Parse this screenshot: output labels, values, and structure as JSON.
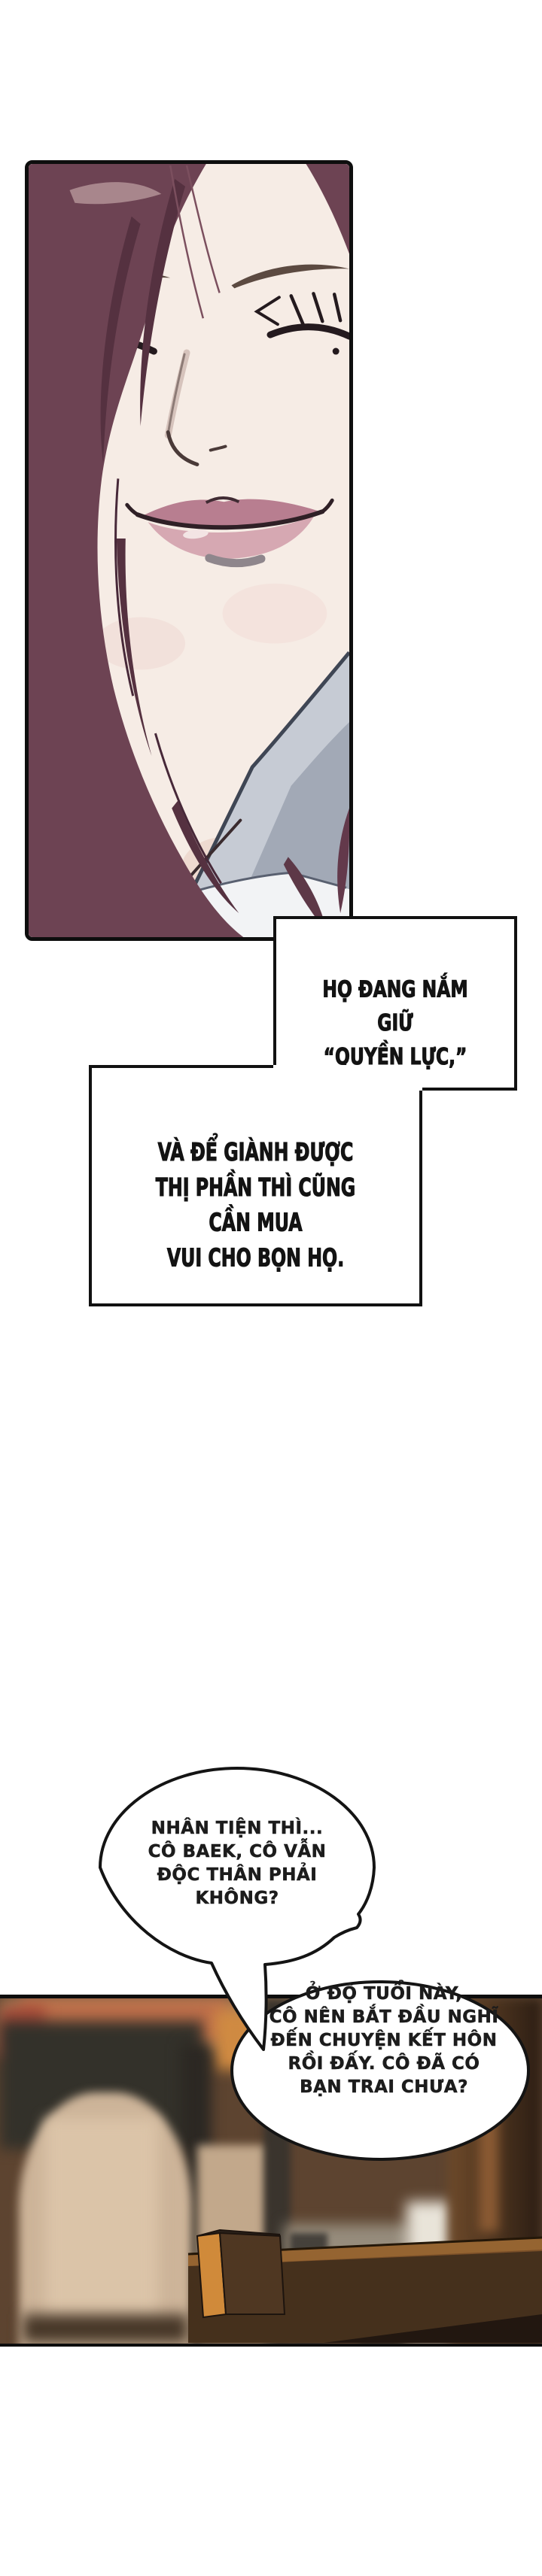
{
  "page": {
    "background": "#ffffff",
    "ink": "#111111"
  },
  "portrait_panel": {
    "subject": "close-up-of-smiling-woman-eyes-closed",
    "colors": {
      "hair": "#6d4353",
      "hair_shadow": "#553140",
      "hair_highlight": "#b39297",
      "skin": "#f6ece5",
      "lips_upper": "#b87e90",
      "lips_lower": "#d6a8b2",
      "clothing_light": "#c6cbd4",
      "clothing_mid": "#a2a9b6"
    }
  },
  "caption_boxes": {
    "box1": {
      "lines": [
        "HỌ ĐANG NẮM GIỮ",
        "“QUYỀN LỰC,”"
      ]
    },
    "box2": {
      "lines": [
        "VÀ ĐỂ GIÀNH ĐƯỢC",
        "THỊ PHẦN THÌ CŨNG CẦN MUA",
        "VUI CHO BỌN HỌ."
      ]
    }
  },
  "speech_bubbles": {
    "bubble1": {
      "lines": [
        "NHÂN TIỆN THÌ...",
        "CÔ BAEK, CÔ VẪN",
        "ĐỘC THÂN PHẢI",
        "KHÔNG?"
      ]
    },
    "bubble2": {
      "lines": [
        "Ở ĐỘ TUỔI NÀY,",
        "CÔ NÊN BẮT ĐẦU NGHĨ",
        "ĐẾN CHUYỆN KẾT HÔN",
        "RỒI ĐẤY. CÔ ĐÃ CÓ",
        "BẠN TRAI CHƯA?"
      ]
    }
  },
  "photo_panel": {
    "subject": "blurred-bar-interior-with-counter-and-lamp",
    "colors": {
      "counter": "#7a4f28",
      "counter_edge": "#9a6733",
      "lamp_beige": "#cdb499",
      "wood_dark": "#2b1d13",
      "accent_orange": "#d08a3a",
      "wall_gray": "#968c7c"
    }
  }
}
